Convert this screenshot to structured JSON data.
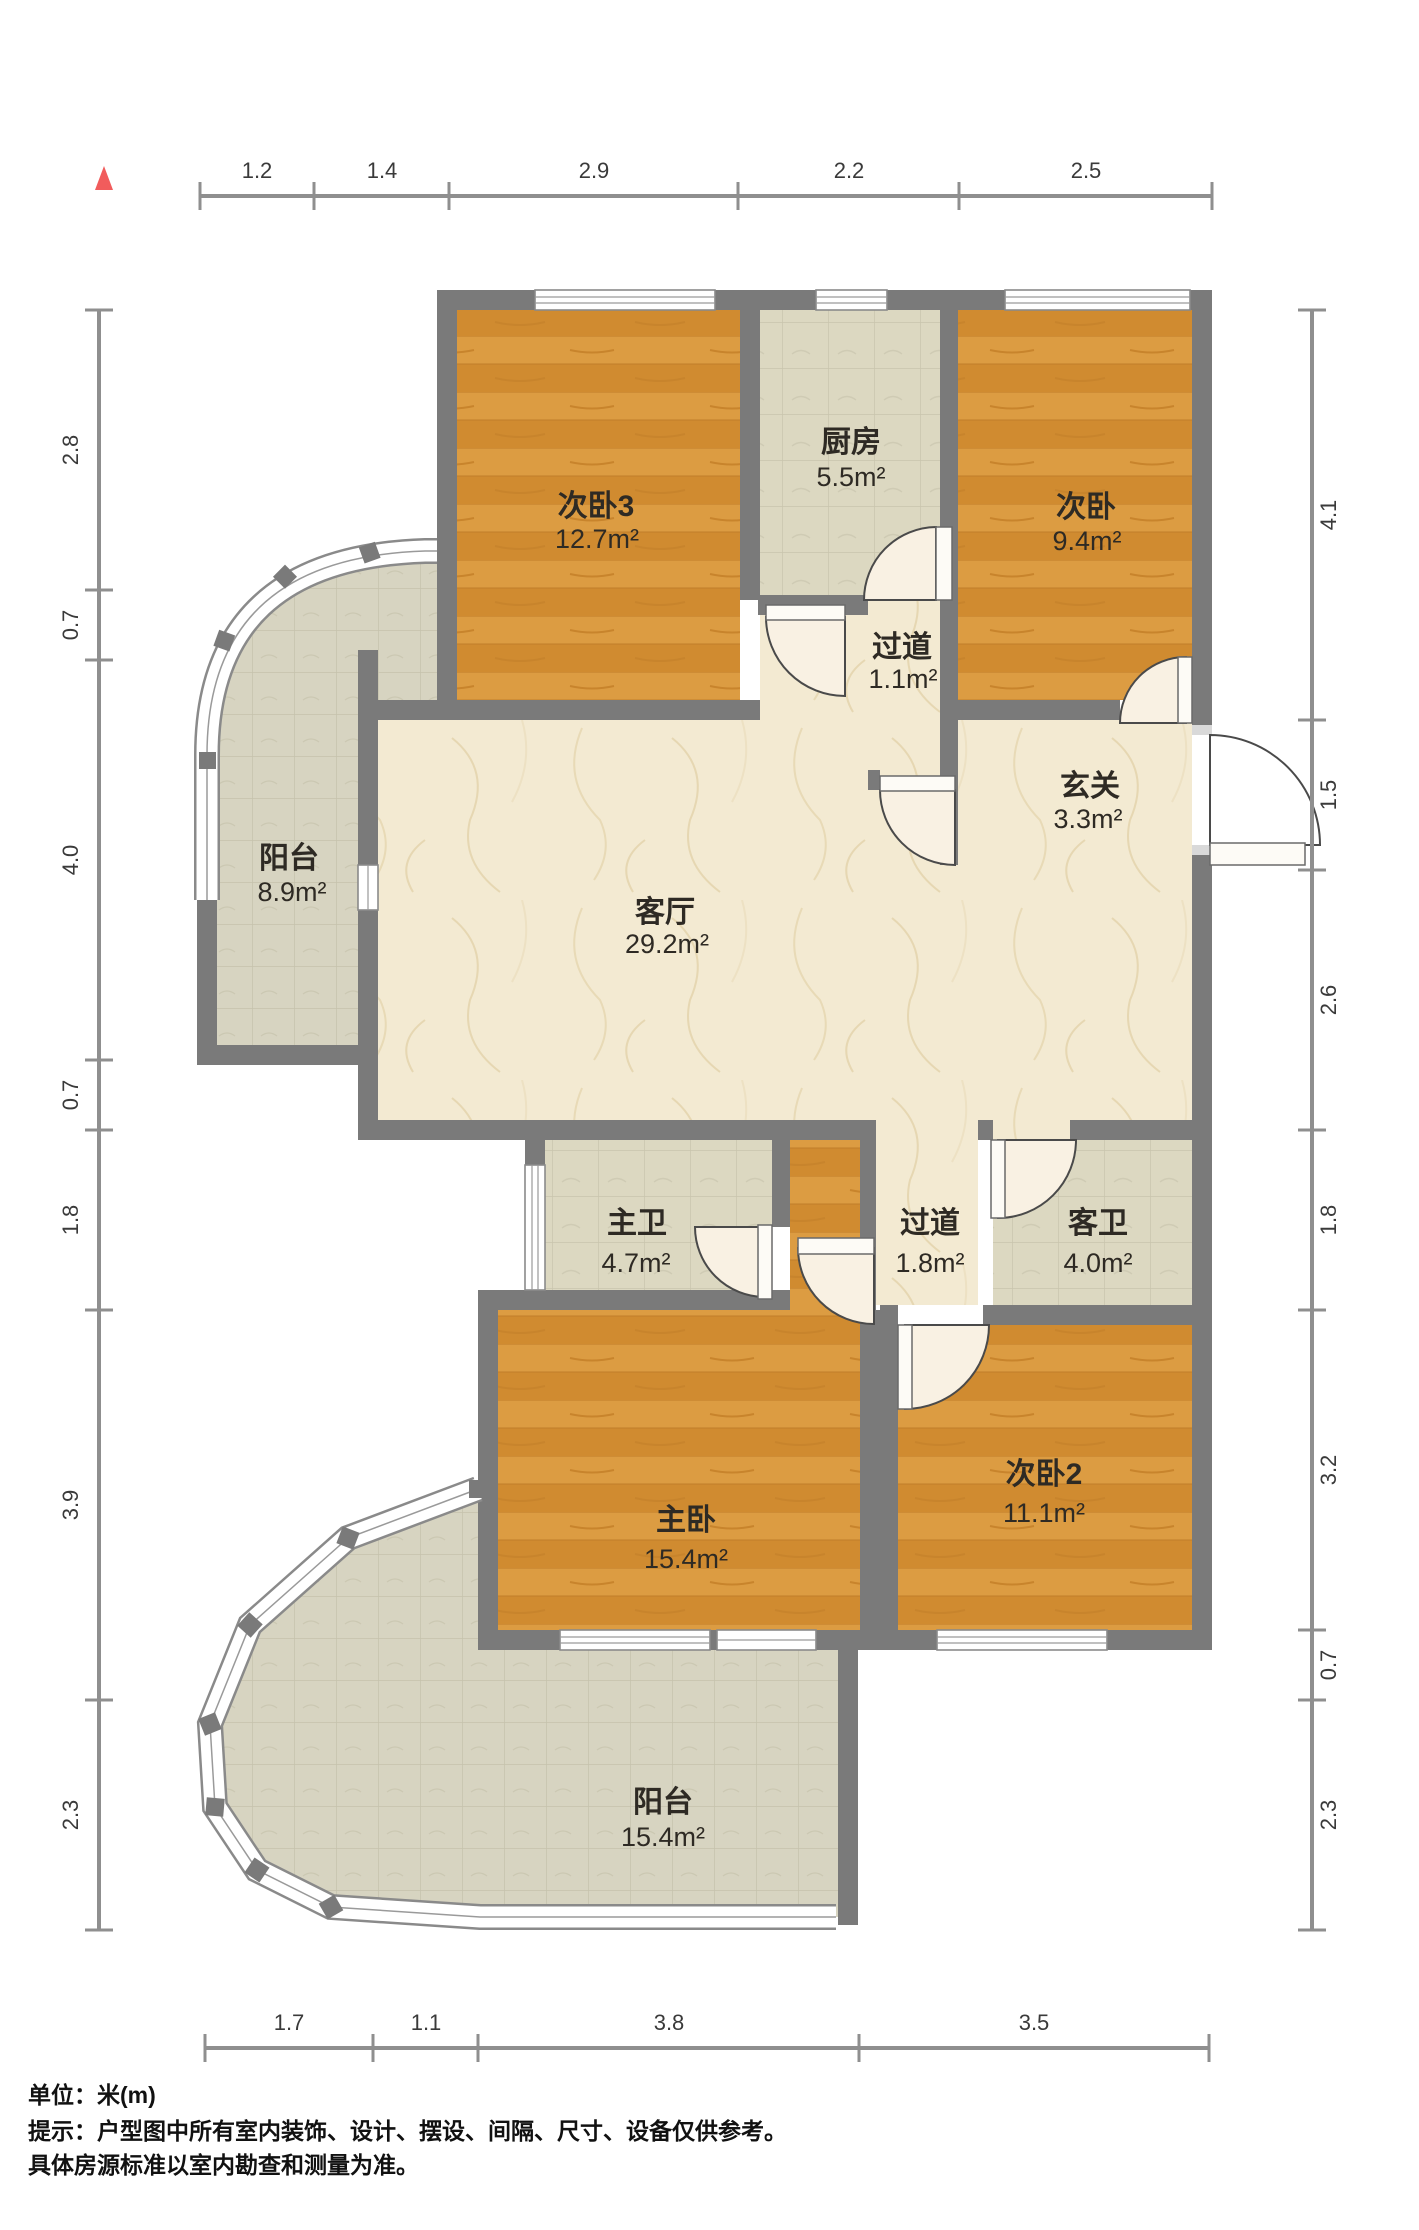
{
  "plan_title": "户型图",
  "north_marker": "north",
  "rooms": {
    "bedroom3": {
      "name": "次卧3",
      "area": "12.7m²"
    },
    "kitchen": {
      "name": "厨房",
      "area": "5.5m²"
    },
    "bedroom_top": {
      "name": "次卧",
      "area": "9.4m²"
    },
    "corridor_top": {
      "name": "过道",
      "area": "1.1m²"
    },
    "entry": {
      "name": "玄关",
      "area": "3.3m²"
    },
    "balcony_left": {
      "name": "阳台",
      "area": "8.9m²"
    },
    "living": {
      "name": "客厅",
      "area": "29.2m²"
    },
    "master_bath": {
      "name": "主卫",
      "area": "4.7m²"
    },
    "corridor_mid": {
      "name": "过道",
      "area": "1.8m²"
    },
    "guest_bath": {
      "name": "客卫",
      "area": "4.0m²"
    },
    "master_bedroom": {
      "name": "主卧",
      "area": "15.4m²"
    },
    "bedroom2": {
      "name": "次卧2",
      "area": "11.1m²"
    },
    "balcony_bottom": {
      "name": "阳台",
      "area": "15.4m²"
    }
  },
  "dims": {
    "top": [
      "1.2",
      "1.4",
      "2.9",
      "2.2",
      "2.5"
    ],
    "bottom": [
      "1.7",
      "1.1",
      "3.8",
      "3.5"
    ],
    "left": [
      "2.8",
      "0.7",
      "4.0",
      "0.7",
      "1.8",
      "3.9",
      "2.3"
    ],
    "right": [
      "4.1",
      "1.5",
      "2.6",
      "1.8",
      "3.2",
      "0.7",
      "2.3"
    ]
  },
  "footnotes": {
    "unit": "单位：米(m)",
    "tip1": "提示：户型图中所有室内装饰、设计、摆设、间隔、尺寸、设备仅供参考。",
    "tip2": "具体房源标准以室内勘查和测量为准。"
  },
  "colors": {
    "wall": "#7a7a7a",
    "wood_floor": "#d79438",
    "marble_floor": "#f3ead2",
    "tile_floor": "#dcd8c1",
    "north_arrow": "#f15c5c"
  }
}
